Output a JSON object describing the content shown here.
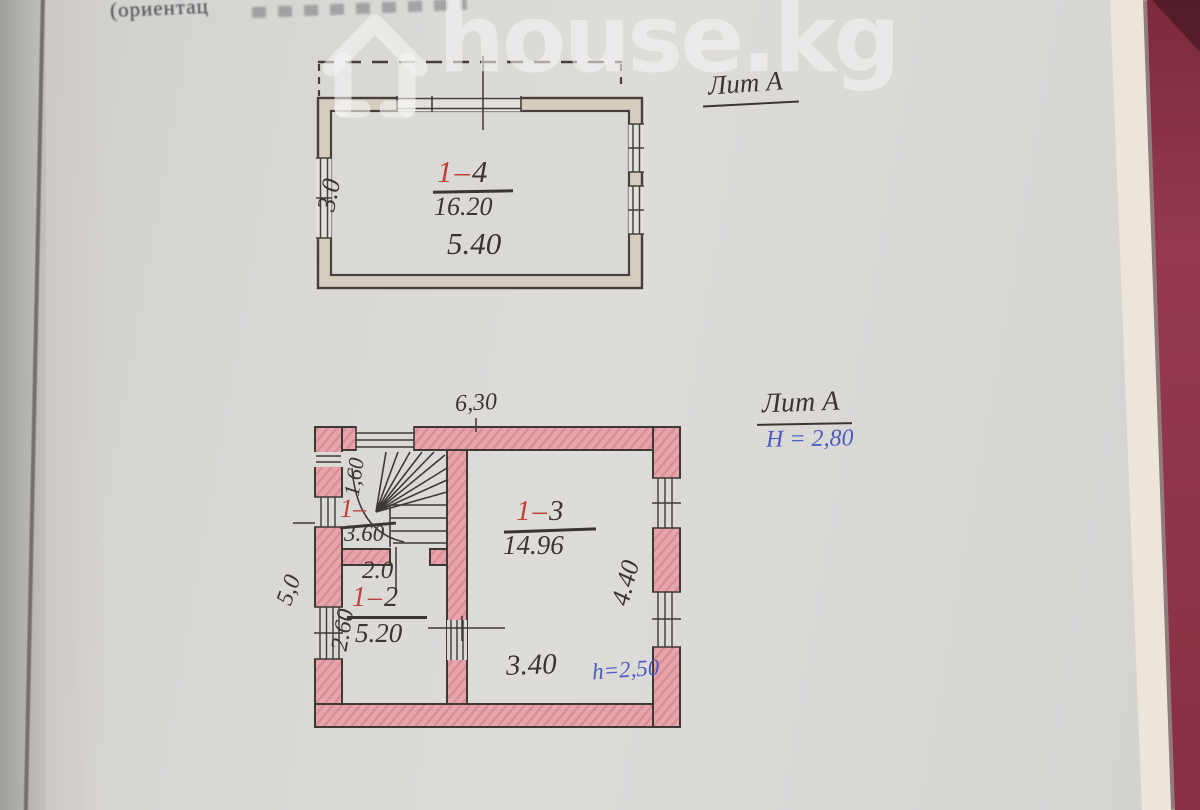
{
  "page": {
    "top_text": "(ориентац",
    "watermark_text": "house.kg"
  },
  "colors": {
    "paper": "#dad8d5",
    "dark_pencil": "#3b3531",
    "red_pencil": "#bf4038",
    "blue_ink": "#4b5bbe",
    "pink_wall": "#e7a4aa",
    "maroon_edge": "#8e3448"
  },
  "upper_plan": {
    "liter": "Лит А",
    "room_label_red": "1–",
    "room_label_dark": "4",
    "area": "16.20",
    "width_dim": "5.40",
    "height_dim": "3.0"
  },
  "lower_plan": {
    "liter": "Лит А",
    "floor_height": "H = 2,80",
    "top_dim": "6,30",
    "outer_left_dim": "5,0",
    "stair": {
      "label_red": "1–",
      "area": "3.60",
      "width_dim": "1,60"
    },
    "room2": {
      "label_red": "1–",
      "label_dark": "2",
      "area": "5.20",
      "top_dim": "2.0",
      "left_dim": "2.60"
    },
    "room3": {
      "label_red": "1–",
      "label_dark": "3",
      "area": "14.96",
      "right_dim": "4.40",
      "bottom_dim": "3.40",
      "ceiling_height": "h=2,50"
    }
  }
}
